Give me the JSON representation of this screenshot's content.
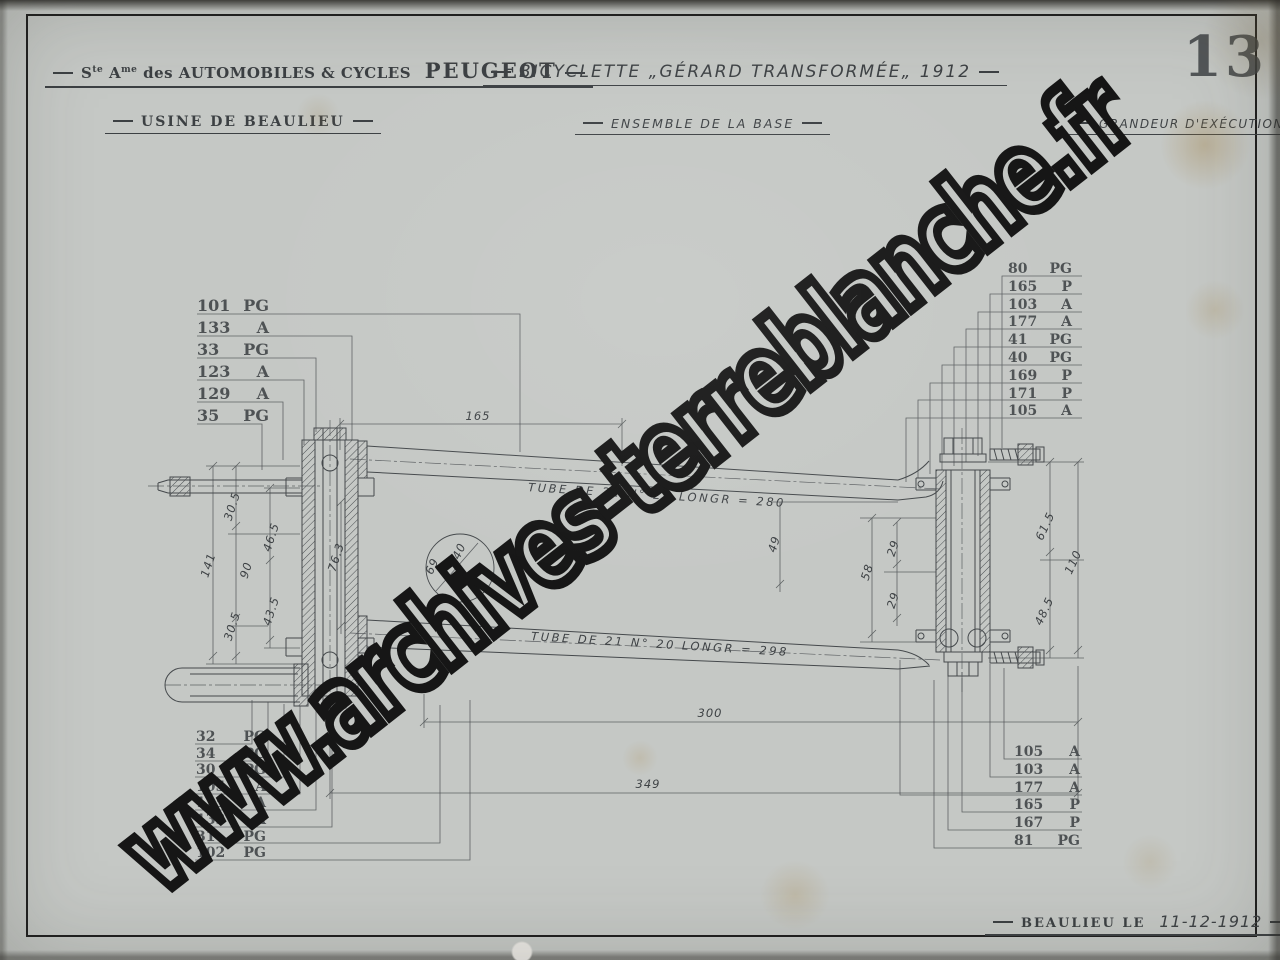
{
  "header": {
    "company_s": "S",
    "company_s_sup": "te",
    "company_a": "A",
    "company_a_sup": "me",
    "company_rest": "des AUTOMOBILES & CYCLES",
    "company_brand": "PEUGEOT",
    "factory": "USINE DE BEAULIEU",
    "title": "BICYCLETTE „GÉRARD TRANSFORMÉE„ 1912",
    "subtitle": "ENSEMBLE DE LA BASE",
    "scale_note": "GRANDEUR D'EXÉCUTION",
    "sheet_number": "13"
  },
  "footer": {
    "place_label": "BEAULIEU LE",
    "date": "11-12-1912"
  },
  "watermark": "www.archives-terreblanche.fr",
  "part_labels": {
    "top_left": [
      "101 PG",
      "133 A",
      "33 PG",
      "123 A",
      "129 A",
      "35 PG"
    ],
    "top_right": [
      "80 PG",
      "165 P",
      "103 A",
      "177 A",
      "41 PG",
      "40 PG",
      "169 P",
      "171 P",
      "105 A"
    ],
    "bottom_left": [
      "32 PG",
      "34 PG",
      "30 PG",
      "105 A",
      "125 A",
      "133 A",
      "31 PG",
      "102 PG"
    ],
    "bottom_right": [
      "105 A",
      "103 A",
      "177 A",
      "165 P",
      "167 P",
      "81 PG"
    ]
  },
  "annotations": {
    "tube_top": "TUBE DE 21   N° 20   LONGR = 280",
    "tube_bottom": "TUBE DE 21   N° 20   LONGR = 298"
  },
  "dimensions": {
    "d165": "165",
    "d300": "300",
    "d349": "349",
    "d141": "141",
    "d90": "90",
    "d305a": "30.5",
    "d465": "46.5",
    "d763": "76.3",
    "d435": "43.5",
    "d305b": "30.5",
    "d69": "69",
    "d40": "40",
    "d49": "49",
    "d58": "58",
    "d29a": "29",
    "d29b": "29",
    "d615": "61.5",
    "d110": "110",
    "d485": "48.5"
  },
  "colors": {
    "ink": "#45494c",
    "paper": "#c5c8c5",
    "frame": "#1e1e1e"
  }
}
